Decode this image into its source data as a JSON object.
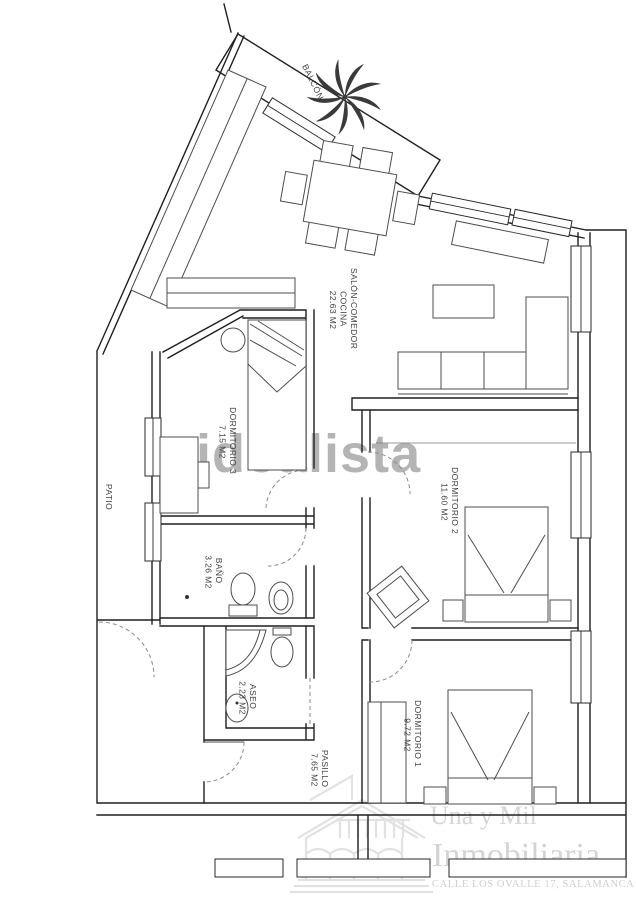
{
  "watermark": {
    "brand": "idealista"
  },
  "agency": {
    "line1": "Una y Mil",
    "line2": "Inmobiliaria",
    "address": "CALLE LOS OVALLE 17, SALAMANCA"
  },
  "rooms": [
    {
      "id": "balcon",
      "name": "BALCÓN",
      "area": ""
    },
    {
      "id": "salon",
      "name": "SALÓN-COMEDOR",
      "name2": "COCINA",
      "area": "22.63 M2"
    },
    {
      "id": "dormitorio3",
      "name": "DORMITORIO 3",
      "area": "7.15 M2"
    },
    {
      "id": "patio",
      "name": "PATIO",
      "area": ""
    },
    {
      "id": "bano",
      "name": "BAÑO",
      "area": "3.26 M2"
    },
    {
      "id": "dormitorio2",
      "name": "DORMITORIO 2",
      "area": "11.60 M2"
    },
    {
      "id": "aseo",
      "name": "ASEO",
      "area": "2.23 M2"
    },
    {
      "id": "dormitorio1",
      "name": "DORMITORIO 1",
      "area": "9.72 M2"
    },
    {
      "id": "pasillo",
      "name": "PASILLO",
      "area": "7.65 M2"
    }
  ],
  "colors": {
    "wall": "#1f1f1f",
    "furniture": "#4d4d4d",
    "label": "#3f3f3f",
    "watermark": "#a2a2a2",
    "agency_text": "#d4d4d4"
  }
}
